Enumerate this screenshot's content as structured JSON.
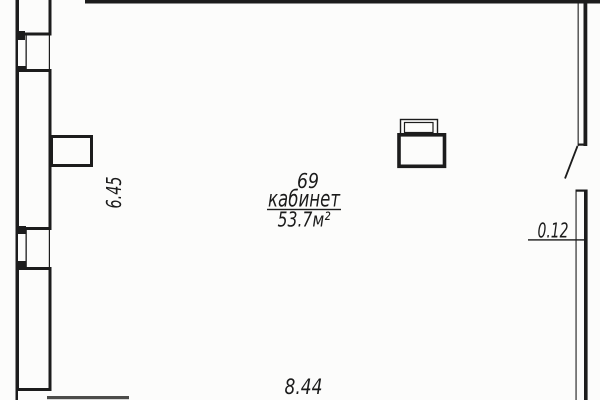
{
  "page": {
    "background": "#fcfcfb",
    "line_color": "#1c1c1c"
  },
  "room": {
    "number": "69",
    "label": "кабинет",
    "area": "53.7м²"
  },
  "dimensions": {
    "left_wall_height": "6.45",
    "bottom_wall_width": "8.44",
    "right_partition_thickness": "0.12"
  }
}
